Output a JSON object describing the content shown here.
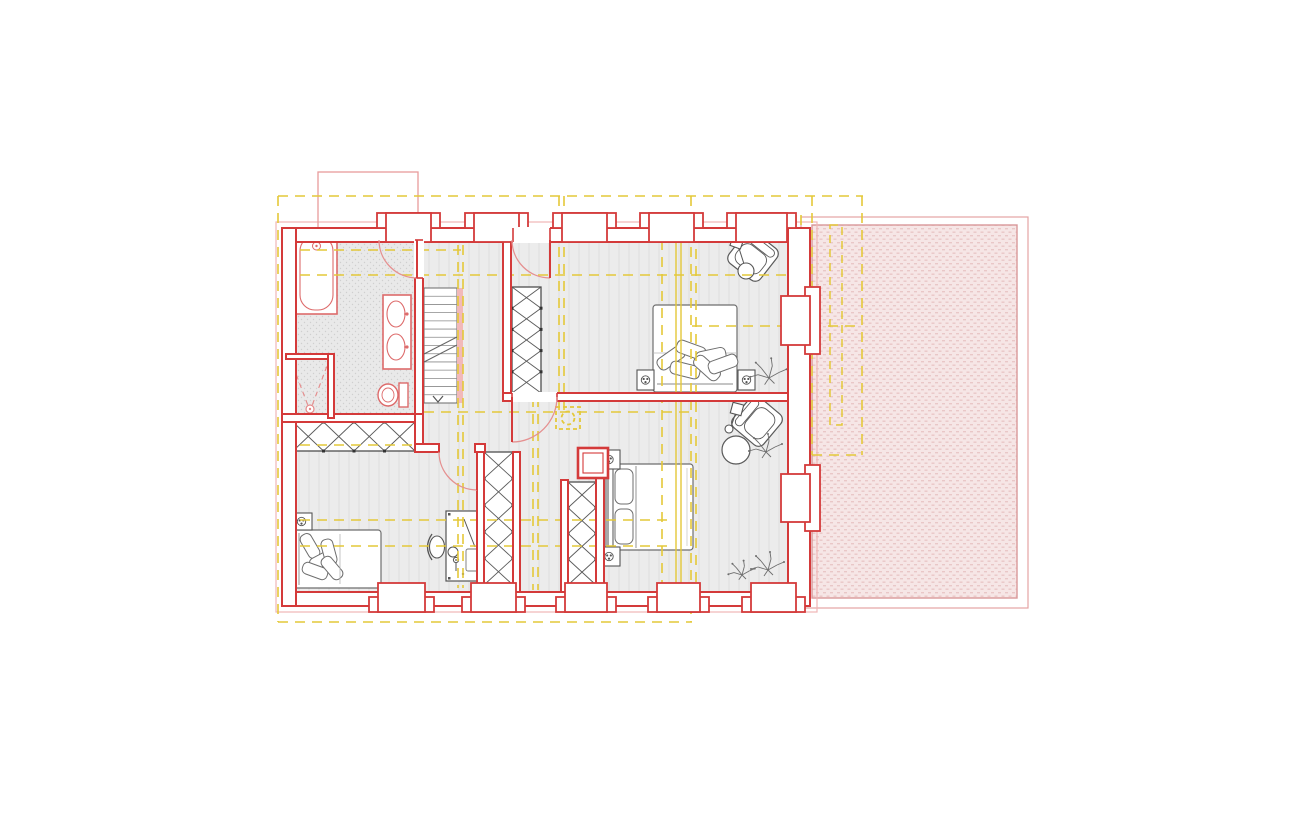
{
  "canvas": {
    "width": 1300,
    "height": 824,
    "background": "#ffffff"
  },
  "palette": {
    "wallRed": "#d43a3a",
    "fixtureRed": "#dd6b6b",
    "doorArc": "#e59090",
    "lightRed": "#efb6b6",
    "terraceEdge": "#d9989a",
    "yellow": "#e4c839",
    "furniture": "#4f4f4f",
    "furnitureLight": "#777777",
    "floorStripe": "#dedede",
    "floorFill": "#ececec",
    "pinkStrip": "#f2b9b9",
    "white": "#ffffff"
  },
  "legend": {
    "red_elements": "new-construction-walls",
    "yellow_dashed": "reference-grid-existing",
    "gray_elements": "furniture",
    "pink_hatch": "terrace-roof-area"
  },
  "layers": [
    {
      "name": "floors",
      "items": [
        {
          "type": "rect",
          "name": "floor-main",
          "x": 290,
          "y": 236,
          "w": 502,
          "h": 360,
          "fill": "url(#pFloor)"
        },
        {
          "type": "rect",
          "name": "floor-bathroom",
          "x": 288,
          "y": 234,
          "w": 131,
          "h": 184,
          "fill": "url(#pBath)"
        },
        {
          "type": "rect",
          "name": "terrace-outline",
          "x": 801,
          "y": 217,
          "w": 227,
          "h": 391,
          "fill": "none",
          "stroke": "#e4a3a3",
          "sw": 1.2
        },
        {
          "type": "rect",
          "name": "terrace-hatch",
          "x": 812,
          "y": 225,
          "w": 205,
          "h": 373,
          "fill": "url(#pTerr)",
          "stroke": "#d9989a",
          "sw": 1.4
        },
        {
          "type": "rect",
          "name": "building-old-outline",
          "x": 276,
          "y": 222,
          "w": 541,
          "h": 390,
          "fill": "none",
          "stroke": "#efb6b6",
          "sw": 1.2
        },
        {
          "type": "rect",
          "name": "chimney-roof-outline",
          "x": 318,
          "y": 172,
          "w": 100,
          "h": 56,
          "fill": "none",
          "stroke": "#e89c9c",
          "sw": 1.3
        }
      ]
    },
    {
      "name": "furniture",
      "items": [
        {
          "type": "stairs",
          "name": "stairs",
          "x": 424,
          "y": 288,
          "w": 33,
          "h": 115,
          "treads": 14
        },
        {
          "type": "rect",
          "name": "stairs-rail-strip",
          "x": 457,
          "y": 288,
          "w": 6,
          "h": 115,
          "fill": "#f2b9b9"
        },
        {
          "type": "wardrobe",
          "name": "wardrobe-hall-row",
          "x": 293,
          "y": 422,
          "w": 122,
          "h": 29,
          "cells": 4,
          "dir": "h"
        },
        {
          "type": "wardrobe",
          "name": "wardrobe-bedroom-ne",
          "x": 512,
          "y": 287,
          "w": 29,
          "h": 106,
          "cells": 5,
          "dir": "v"
        },
        {
          "type": "wardrobe",
          "name": "wardrobe-niche-west",
          "x": 484,
          "y": 452,
          "w": 29,
          "h": 133,
          "cells": 5,
          "dir": "v"
        },
        {
          "type": "wardrobe",
          "name": "wardrobe-niche-east",
          "x": 568,
          "y": 482,
          "w": 28,
          "h": 103,
          "cells": 4,
          "dir": "v"
        },
        {
          "type": "bed",
          "name": "bed-bedroom-ne",
          "x": 653,
          "y": 305,
          "w": 84,
          "h": 87,
          "head": "s",
          "style": "messy"
        },
        {
          "type": "bed",
          "name": "bed-bedroom-se",
          "x": 606,
          "y": 464,
          "w": 87,
          "h": 86,
          "head": "w",
          "style": "neat"
        },
        {
          "type": "bed",
          "name": "bed-bedroom-sw",
          "x": 292,
          "y": 530,
          "w": 89,
          "h": 58,
          "head": "w",
          "style": "messy"
        },
        {
          "type": "nightstand",
          "name": "nightstand",
          "x": 637,
          "y": 370,
          "w": 17,
          "h": 20
        },
        {
          "type": "nightstand",
          "name": "nightstand",
          "x": 738,
          "y": 370,
          "w": 17,
          "h": 20
        },
        {
          "type": "nightstand",
          "name": "nightstand",
          "x": 598,
          "y": 450,
          "w": 22,
          "h": 19
        },
        {
          "type": "nightstand",
          "name": "nightstand",
          "x": 598,
          "y": 547,
          "w": 22,
          "h": 19
        },
        {
          "type": "nightstand",
          "name": "nightstand",
          "x": 291,
          "y": 513,
          "w": 21,
          "h": 17
        },
        {
          "type": "desk",
          "name": "desk",
          "x": 446,
          "y": 511,
          "w": 36,
          "h": 70
        },
        {
          "type": "chair",
          "name": "desk-chair",
          "cx": 437,
          "cy": 547
        },
        {
          "type": "armchair",
          "name": "armchair-ne",
          "cx": 753,
          "cy": 256,
          "rot": 38,
          "s": 40
        },
        {
          "type": "armchair",
          "name": "armchair-se",
          "cx": 757,
          "cy": 421,
          "rot": -50,
          "s": 40
        },
        {
          "type": "floorlamp",
          "name": "floor-lamp-ne",
          "hx": 737,
          "hy": 242,
          "rot": 20,
          "bx": 744,
          "by": 264,
          "cx": 746,
          "cy": 271,
          "br": 8
        },
        {
          "type": "floorlamp",
          "name": "floor-lamp-se",
          "hx": 737,
          "hy": 409,
          "rot": 15,
          "bx": 731,
          "by": 427,
          "cx": 729,
          "cy": 429,
          "br": 4
        },
        {
          "type": "circle",
          "name": "side-table",
          "cx": 736,
          "cy": 450,
          "r": 14,
          "fill": "#ffffff",
          "stroke": "#5a5a5a",
          "sw": 1.2
        },
        {
          "type": "plant",
          "name": "plant",
          "cx": 769,
          "cy": 378,
          "s": 1.1
        },
        {
          "type": "plant",
          "name": "plant",
          "cx": 766,
          "cy": 452,
          "s": 1.0
        },
        {
          "type": "plant",
          "name": "plant",
          "cx": 768,
          "cy": 570,
          "s": 1.0
        },
        {
          "type": "plant",
          "name": "plant",
          "cx": 742,
          "cy": 575,
          "s": 0.8
        },
        {
          "type": "tub",
          "name": "bathtub",
          "x": 296,
          "y": 232,
          "w": 41,
          "h": 82
        },
        {
          "type": "vanity",
          "name": "vanity-double-sink",
          "x": 383,
          "y": 295,
          "w": 28,
          "h": 74
        },
        {
          "type": "toilet",
          "name": "toilet",
          "x": 380,
          "y": 383
        },
        {
          "type": "shower",
          "name": "shower",
          "x": 288,
          "y": 356,
          "w": 44,
          "h": 58
        }
      ]
    },
    {
      "name": "grid-lines",
      "items": [
        {
          "type": "line",
          "name": "grid-line-h",
          "x1": 278,
          "y1": 196,
          "x2": 863,
          "y2": 196,
          "yellow": true
        },
        {
          "type": "line",
          "name": "grid-line-h",
          "x1": 283,
          "y1": 250,
          "x2": 461,
          "y2": 250,
          "yellow": true
        },
        {
          "type": "line",
          "name": "grid-line-h",
          "x1": 283,
          "y1": 275,
          "x2": 787,
          "y2": 275,
          "yellow": true
        },
        {
          "type": "line",
          "name": "grid-line-h",
          "x1": 692,
          "y1": 326,
          "x2": 862,
          "y2": 326,
          "yellow": true
        },
        {
          "type": "line",
          "name": "grid-line-h",
          "x1": 424,
          "y1": 412,
          "x2": 691,
          "y2": 412,
          "yellow": true
        },
        {
          "type": "line",
          "name": "grid-line-h",
          "x1": 283,
          "y1": 445,
          "x2": 414,
          "y2": 445,
          "yellow": true
        },
        {
          "type": "line",
          "name": "grid-line-h",
          "x1": 283,
          "y1": 520,
          "x2": 671,
          "y2": 520,
          "yellow": true
        },
        {
          "type": "line",
          "name": "grid-line-h",
          "x1": 283,
          "y1": 546,
          "x2": 671,
          "y2": 546,
          "yellow": true
        },
        {
          "type": "line",
          "name": "grid-line-h",
          "x1": 278,
          "y1": 622,
          "x2": 692,
          "y2": 622,
          "yellow": true
        },
        {
          "type": "line",
          "name": "grid-line-h",
          "x1": 812,
          "y1": 455,
          "x2": 862,
          "y2": 455,
          "yellow": true
        },
        {
          "type": "line",
          "name": "grid-line-v",
          "x1": 278,
          "y1": 196,
          "x2": 278,
          "y2": 622,
          "yellow": true
        },
        {
          "type": "line",
          "name": "grid-line-v",
          "x1": 458,
          "y1": 228,
          "x2": 458,
          "y2": 588,
          "yellow": true
        },
        {
          "type": "line",
          "name": "grid-line-v",
          "x1": 463,
          "y1": 228,
          "x2": 463,
          "y2": 588,
          "yellow": true
        },
        {
          "type": "line",
          "name": "grid-line-v",
          "x1": 533,
          "y1": 397,
          "x2": 533,
          "y2": 590,
          "yellow": true
        },
        {
          "type": "line",
          "name": "grid-line-v",
          "x1": 538,
          "y1": 397,
          "x2": 538,
          "y2": 590,
          "yellow": true
        },
        {
          "type": "line",
          "name": "grid-line-v",
          "x1": 559,
          "y1": 196,
          "x2": 559,
          "y2": 412,
          "yellow": true
        },
        {
          "type": "line",
          "name": "grid-line-v",
          "x1": 564,
          "y1": 196,
          "x2": 564,
          "y2": 412,
          "yellow": true
        },
        {
          "type": "line",
          "name": "grid-line-v",
          "x1": 662,
          "y1": 240,
          "x2": 662,
          "y2": 588,
          "yellow": true
        },
        {
          "type": "line",
          "name": "grid-line-v-solid",
          "x1": 676,
          "y1": 215,
          "x2": 676,
          "y2": 588,
          "stroke": "#e4c839",
          "sw": 1.4
        },
        {
          "type": "line",
          "name": "grid-line-v-solid",
          "x1": 681,
          "y1": 215,
          "x2": 681,
          "y2": 588,
          "stroke": "#e4c839",
          "sw": 1.4
        },
        {
          "type": "line",
          "name": "grid-line-v",
          "x1": 691,
          "y1": 196,
          "x2": 691,
          "y2": 622,
          "yellow": true
        },
        {
          "type": "line",
          "name": "grid-line-v",
          "x1": 696,
          "y1": 215,
          "x2": 696,
          "y2": 588,
          "yellow": true
        },
        {
          "type": "line",
          "name": "grid-line-v",
          "x1": 796,
          "y1": 215,
          "x2": 796,
          "y2": 580,
          "yellow": true
        },
        {
          "type": "line",
          "name": "grid-line-v",
          "x1": 801,
          "y1": 215,
          "x2": 801,
          "y2": 580,
          "yellow": true
        },
        {
          "type": "line",
          "name": "grid-line-v",
          "x1": 812,
          "y1": 196,
          "x2": 812,
          "y2": 455,
          "yellow": true
        },
        {
          "type": "line",
          "name": "grid-line-v",
          "x1": 862,
          "y1": 196,
          "x2": 862,
          "y2": 455,
          "yellow": true
        },
        {
          "type": "rect",
          "name": "grid-slim-box",
          "x": 830,
          "y": 225,
          "w": 12,
          "h": 200,
          "fill": "none",
          "stroke": "#e4c839",
          "sw": 1.5,
          "dash": "8 6"
        },
        {
          "type": "chimneyYellow",
          "name": "chimney-symbol-existing",
          "x": 556,
          "y": 407,
          "w": 24,
          "h": 22
        }
      ]
    },
    {
      "name": "walls",
      "items": [
        {
          "type": "wall",
          "name": "wall-ext-top",
          "x": 282,
          "y": 228,
          "w": 528,
          "h": 14
        },
        {
          "type": "wall",
          "name": "wall-ext-bottom",
          "x": 282,
          "y": 592,
          "w": 528,
          "h": 14
        },
        {
          "type": "wall",
          "name": "wall-ext-left",
          "x": 282,
          "y": 228,
          "w": 14,
          "h": 378
        },
        {
          "type": "wall",
          "name": "wall-ext-right",
          "x": 788,
          "y": 228,
          "w": 22,
          "h": 378
        },
        {
          "type": "wall",
          "name": "wall-bathroom-east",
          "x": 415,
          "y": 228,
          "w": 8,
          "h": 192
        },
        {
          "type": "wall",
          "name": "wall-bathroom-south",
          "x": 282,
          "y": 414,
          "w": 141,
          "h": 8
        },
        {
          "type": "wall",
          "name": "wall-shower-top",
          "x": 286,
          "y": 354,
          "w": 46,
          "h": 5
        },
        {
          "type": "wall",
          "name": "wall-shower-right",
          "x": 328,
          "y": 354,
          "w": 6,
          "h": 64
        },
        {
          "type": "wall",
          "name": "wall-hall-east",
          "x": 503,
          "y": 232,
          "w": 8,
          "h": 165
        },
        {
          "type": "wall",
          "name": "wall-mid-horizontal",
          "x": 503,
          "y": 393,
          "w": 285,
          "h": 8
        },
        {
          "type": "wall",
          "name": "wall-hall-corner-v",
          "x": 415,
          "y": 414,
          "w": 8,
          "h": 38
        },
        {
          "type": "wall",
          "name": "wall-hall-corner-h",
          "x": 415,
          "y": 444,
          "w": 24,
          "h": 8
        },
        {
          "type": "wall",
          "name": "wall-door-stub",
          "x": 475,
          "y": 444,
          "w": 10,
          "h": 8
        },
        {
          "type": "wall",
          "name": "wall-niche-w-left",
          "x": 477,
          "y": 452,
          "w": 7,
          "h": 140
        },
        {
          "type": "wall",
          "name": "wall-niche-w-right",
          "x": 513,
          "y": 452,
          "w": 7,
          "h": 140
        },
        {
          "type": "wall",
          "name": "wall-niche-e-left",
          "x": 561,
          "y": 480,
          "w": 7,
          "h": 112
        },
        {
          "type": "wall",
          "name": "wall-niche-e-right",
          "x": 596,
          "y": 448,
          "w": 8,
          "h": 144
        }
      ]
    },
    {
      "name": "openings",
      "items": [
        {
          "type": "window",
          "name": "window-top",
          "side": "top",
          "a1": 386,
          "a2": 431
        },
        {
          "type": "window",
          "name": "window-top",
          "side": "top",
          "a1": 474,
          "a2": 519
        },
        {
          "type": "window",
          "name": "window-top",
          "side": "top",
          "a1": 562,
          "a2": 607
        },
        {
          "type": "window",
          "name": "window-top",
          "side": "top",
          "a1": 649,
          "a2": 694
        },
        {
          "type": "window",
          "name": "window-top",
          "side": "top",
          "a1": 736,
          "a2": 787
        },
        {
          "type": "window",
          "name": "window-bottom",
          "side": "bottom",
          "a1": 378,
          "a2": 425
        },
        {
          "type": "window",
          "name": "window-bottom",
          "side": "bottom",
          "a1": 471,
          "a2": 516
        },
        {
          "type": "window",
          "name": "window-bottom",
          "side": "bottom",
          "a1": 565,
          "a2": 607
        },
        {
          "type": "window",
          "name": "window-bottom",
          "side": "bottom",
          "a1": 657,
          "a2": 700
        },
        {
          "type": "window",
          "name": "window-bottom",
          "side": "bottom",
          "a1": 751,
          "a2": 796
        },
        {
          "type": "window",
          "name": "window-right",
          "side": "right",
          "a1": 296,
          "a2": 345
        },
        {
          "type": "window",
          "name": "window-right",
          "side": "right",
          "a1": 474,
          "a2": 522
        },
        {
          "type": "door",
          "name": "door-bathroom",
          "gap": {
            "x": 414,
            "y": 240,
            "w": 10,
            "h": 38
          },
          "jambs": [
            [
              415,
              240,
              423,
              240
            ],
            [
              415,
              278,
              423,
              278
            ]
          ],
          "leaf": [
            417,
            240,
            417,
            278
          ],
          "arc": "M379,240 A38,38 0 0 0 417,278"
        },
        {
          "type": "door",
          "name": "door-bedroom-ne",
          "gap": {
            "x": 513,
            "y": 227,
            "w": 37,
            "h": 16
          },
          "jambs": [
            [
              513,
              228,
              513,
              242
            ],
            [
              550,
              228,
              550,
              242
            ]
          ],
          "leaf": [
            550,
            240,
            550,
            278
          ],
          "arc": "M512,240 A38,38 0 0 0 550,278"
        },
        {
          "type": "door",
          "name": "door-bedroom-se",
          "gap": {
            "x": 512,
            "y": 392,
            "w": 45,
            "h": 10
          },
          "jambs": [
            [
              512,
              393,
              512,
              401
            ],
            [
              557,
              393,
              557,
              401
            ]
          ],
          "leaf": [
            512,
            397,
            512,
            442
          ],
          "arc": "M557,397 A45,45 0 0 1 512,442"
        },
        {
          "type": "door",
          "name": "door-bedroom-sw",
          "gap": null,
          "jambs": [],
          "leaf": [
            477,
            452,
            477,
            490
          ],
          "arc": "M439,452 A38,38 0 0 0 477,490"
        }
      ]
    },
    {
      "name": "symbols",
      "items": [
        {
          "type": "chimneyRed",
          "name": "chimney-new",
          "x": 578,
          "y": 448,
          "w": 30,
          "h": 30
        }
      ]
    }
  ]
}
